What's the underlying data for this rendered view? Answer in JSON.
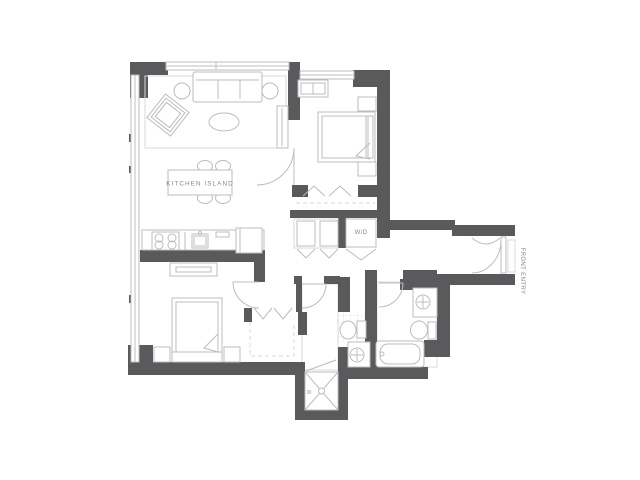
{
  "labels": {
    "kitchen_island": "KITCHEN ISLAND",
    "washer_dryer": "W/D",
    "front_entry": "FRONT ENTRY"
  },
  "colors": {
    "wall": "#5a5a5d",
    "line": "#bcbcc0",
    "line-light": "#d9d9dc",
    "tile": "#e2e2e5",
    "text": "#85868a",
    "bg": "#ffffff"
  }
}
